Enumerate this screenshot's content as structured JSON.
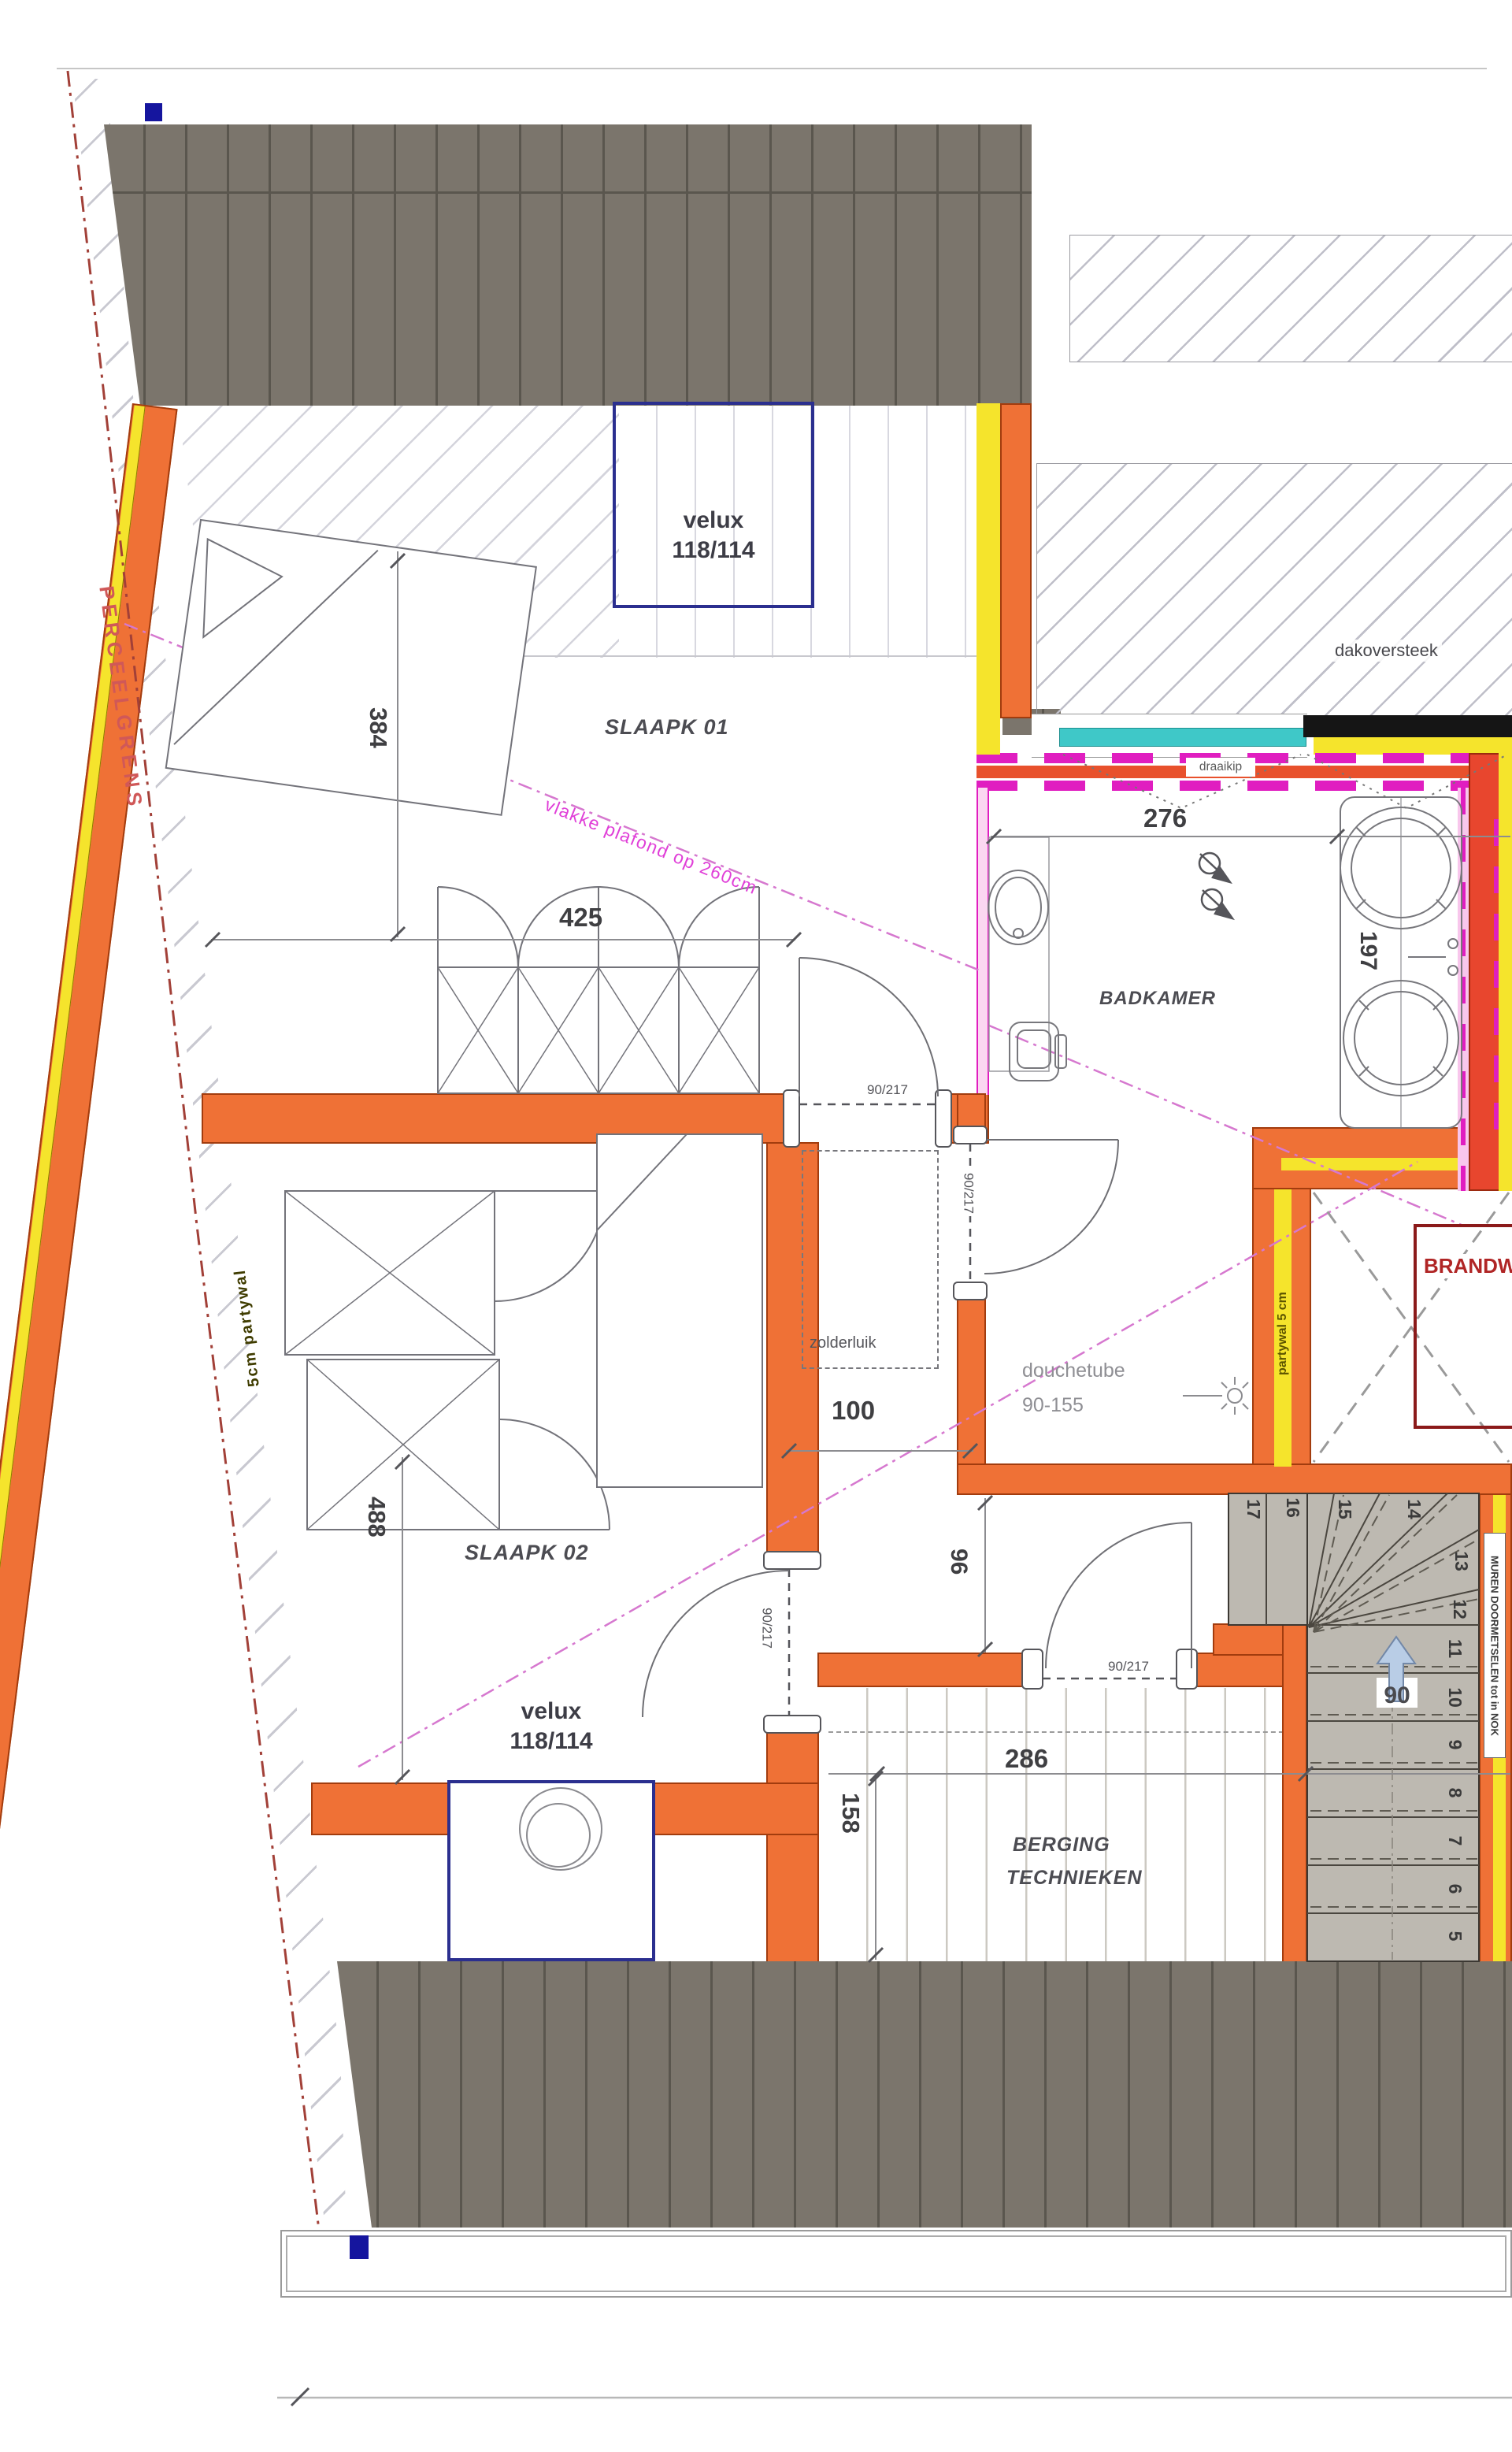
{
  "plan": {
    "rooms": {
      "slaapk01": "SLAAPK 01",
      "slaapk02": "SLAAPK 02",
      "badkamer": "BADKAMER",
      "berging_line1": "BERGING",
      "berging_line2": "TECHNIEKEN"
    },
    "velux": {
      "label": "velux",
      "size": "118/114"
    },
    "dimensions": {
      "d384": "384",
      "d425": "425",
      "d276": "276",
      "d197": "197",
      "d100": "100",
      "d96": "96",
      "d488": "488",
      "d286": "286",
      "d158": "158"
    },
    "door_label": "90/217",
    "stairs": {
      "numbers": [
        "5",
        "6",
        "7",
        "8",
        "9",
        "10",
        "11",
        "12",
        "13",
        "14",
        "15",
        "16",
        "17"
      ],
      "width": "90",
      "note": "MUREN DOORMETSELEN tot in NOK"
    },
    "annotations": {
      "perceelgrens": "PERCEELGRENS",
      "partywal_left": "5cm partywal",
      "partywal_right": "partywal 5 cm",
      "vlakke_plafond": "vlakke plafond op 260cm",
      "dakoversteek": "dakoversteek",
      "draaikip": "draaikip",
      "zolderluik": "zolderluik",
      "douchetube_line1": "douchetube",
      "douchetube_line2": "90-155",
      "brandwerend": "BRANDW"
    },
    "colors": {
      "wall_orange": "#EF7136",
      "insulation_yellow": "#F5E42C",
      "glazing_cyan": "#3FC8C8",
      "fire_magenta": "#E01EC0",
      "boundary_red": "#A24038",
      "velux_blue": "#2B2F8F",
      "roof_dark": "#7B756C",
      "brand_red": "#8B1A1A",
      "tread_gray": "#BDB9B1"
    }
  }
}
